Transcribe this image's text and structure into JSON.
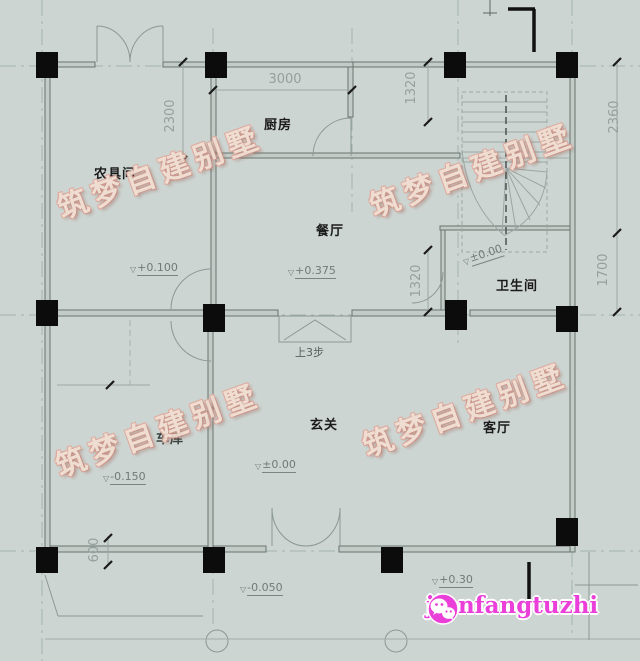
{
  "watermark": {
    "text": "筑梦自建别墅"
  },
  "logo": {
    "text": "jianfangtuzhi",
    "icon": "wechat-icon",
    "color": "#ea3fd8"
  },
  "rooms": {
    "farm_tool_room": "农具间",
    "kitchen": "厨房",
    "dining": "餐厅",
    "bathroom": "卫生间",
    "foyer": "玄关",
    "living": "客厅",
    "garage": "车库"
  },
  "dimensions": {
    "top_width": "3000",
    "left_top": "2300",
    "stair_top": "1320",
    "right_top": "2360",
    "right_mid": "1700",
    "stair_mid": "1320",
    "bottom_left": "600"
  },
  "elevations": {
    "farm_tool": "+0.100",
    "dining": "+0.375",
    "stair": "±0.00",
    "foyer": "±0.00",
    "garage": "-0.150",
    "driveway": "-0.050",
    "porch": "+0.30"
  },
  "annotations": {
    "steps_note": "上3步",
    "triangle_glyph": "▽"
  },
  "colors": {
    "background": "#cdd5d2",
    "line": "#8b9894",
    "wall_fill": "#c2cbc7",
    "wall_edge": "#68756f",
    "column": "#0c0c0c",
    "dimension_text": "#94a09c",
    "room_text": "#1b1b1b",
    "watermark_fill": "#f3ded2",
    "watermark_outline": "#e0aa9e",
    "logo_pink": "#ea3fd8"
  }
}
